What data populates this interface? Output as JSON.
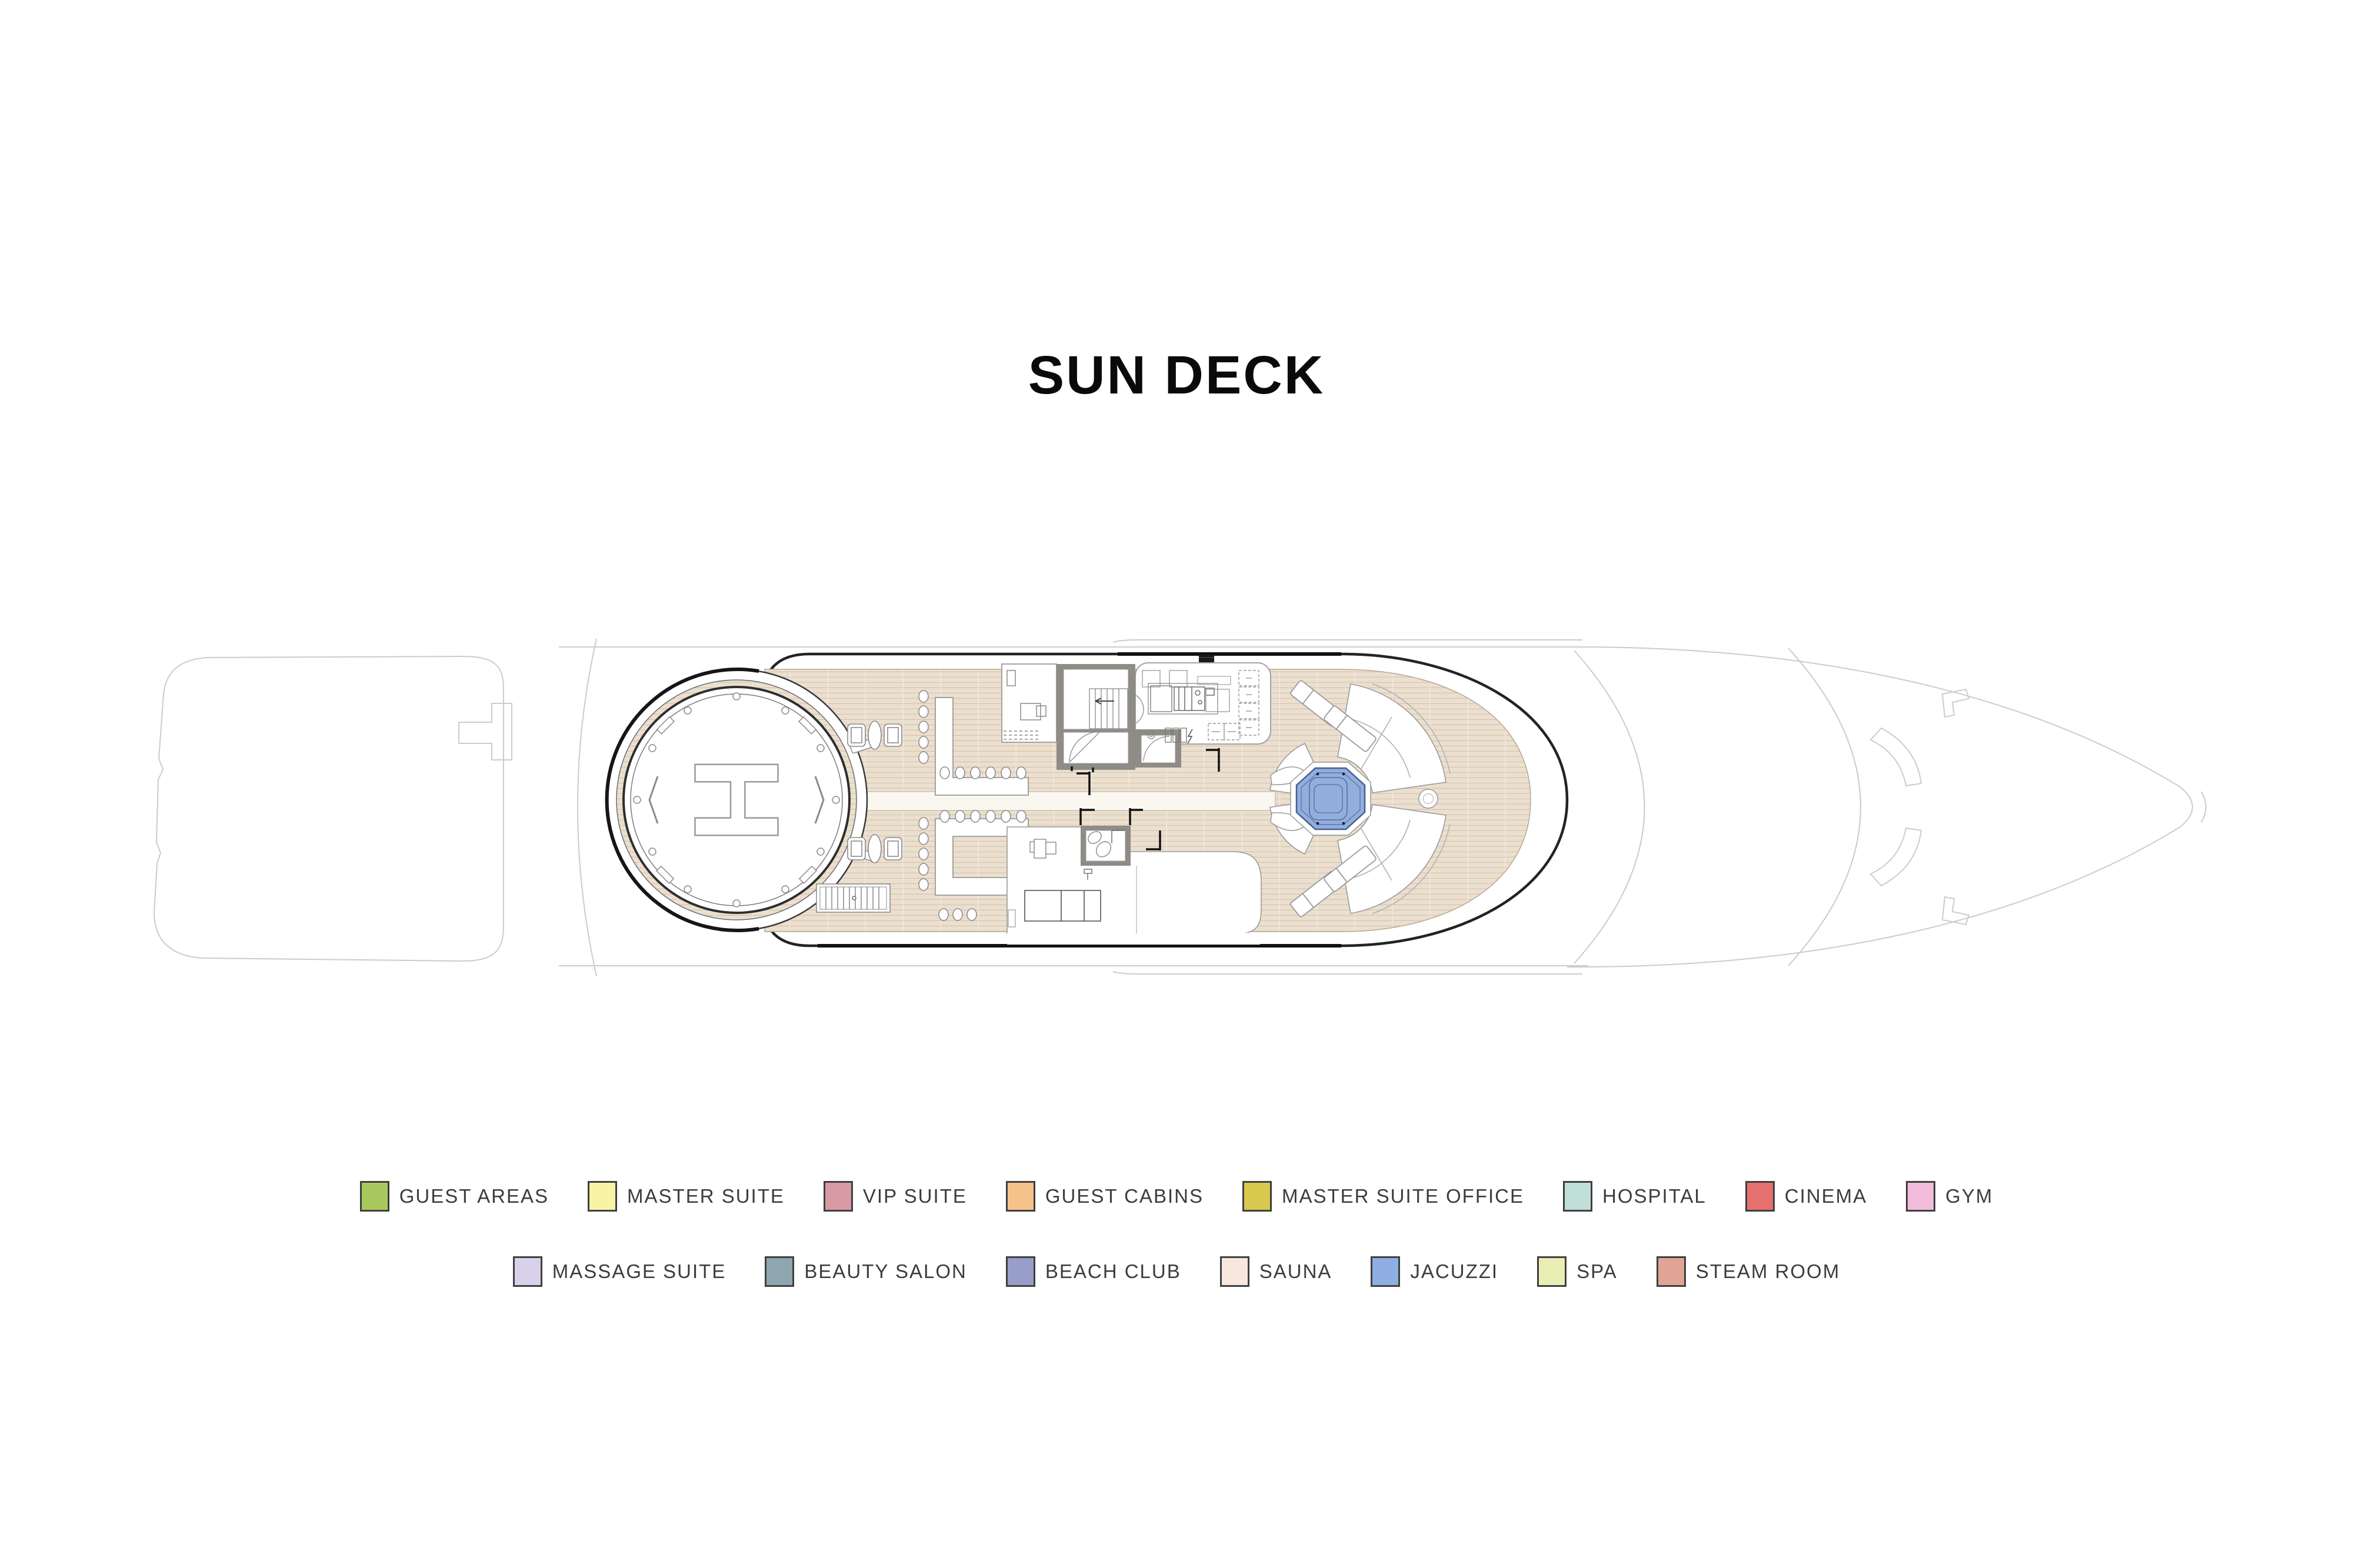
{
  "title": "SUN DECK",
  "plan": {
    "helipad_label": "H",
    "colors": {
      "deck": "#ebdfcf",
      "deck_line": "#d8c5ae",
      "deck_seam": "#f4ece0",
      "jacuzzi": "#92aede",
      "jacuzzi_border": "#44608f",
      "wall_gray": "#8f8b86",
      "outline_dark": "#232323",
      "hull_faint": "#cccccc"
    }
  },
  "legend": {
    "swatch_border": "#3f3f3f",
    "text_color": "#3c3c3c",
    "rows": [
      [
        {
          "label": "GUEST AREAS",
          "color": "#a9c85e"
        },
        {
          "label": "MASTER SUITE",
          "color": "#f9f3a5"
        },
        {
          "label": "VIP SUITE",
          "color": "#d79aa2"
        },
        {
          "label": "GUEST CABINS",
          "color": "#f6c28b"
        },
        {
          "label": "MASTER SUITE OFFICE",
          "color": "#d9c94e"
        },
        {
          "label": "HOSPITAL",
          "color": "#bfdfd8"
        },
        {
          "label": "CINEMA",
          "color": "#e57070"
        },
        {
          "label": "GYM",
          "color": "#f3bcdb"
        }
      ],
      [
        {
          "label": "MASSAGE SUITE",
          "color": "#d9d1ea"
        },
        {
          "label": "BEAUTY SALON",
          "color": "#8ea7af"
        },
        {
          "label": "BEACH CLUB",
          "color": "#989ec8"
        },
        {
          "label": "SAUNA",
          "color": "#f6e8df"
        },
        {
          "label": "JACUZZI",
          "color": "#8fafe2"
        },
        {
          "label": "SPA",
          "color": "#eaeeb5"
        },
        {
          "label": "STEAM ROOM",
          "color": "#e0a495"
        }
      ]
    ]
  }
}
